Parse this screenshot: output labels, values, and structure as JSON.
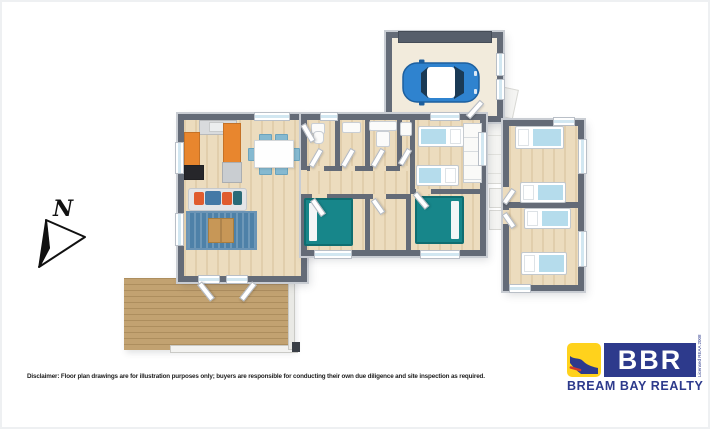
{
  "compass": {
    "label": "N"
  },
  "disclaimer": "Disclaimer: Floor plan drawings are for illustration purposes only; buyers are responsible for conducting their own due diligence and site inspection as required.",
  "logo": {
    "acronym": "BBR",
    "name": "BREAM BAY REALTY",
    "license": "Licensed REAA 2008"
  },
  "icons": {
    "compass": "north-arrow-icon",
    "garage_vehicle": "car-top-view-icon"
  },
  "palette": {
    "wall": "#646b77",
    "wall_light": "#c9cdd3",
    "floor_wood": "#ecdcbe",
    "garage_floor": "#f2ebdc",
    "deck": "#c2a271",
    "teal_bed": "#17868a",
    "light_blue": "#b5dcec",
    "car_blue": "#2f83cf",
    "counter_orange": "#e8862e",
    "rug_blue": "#4e81a8",
    "table_wood": "#c79757",
    "sofa_orange": "#e05c2e",
    "sofa_blue": "#4479a6",
    "logo_blue": "#2d3a8c",
    "logo_yellow": "#ffd21c",
    "logo_red": "#d03a2b"
  }
}
